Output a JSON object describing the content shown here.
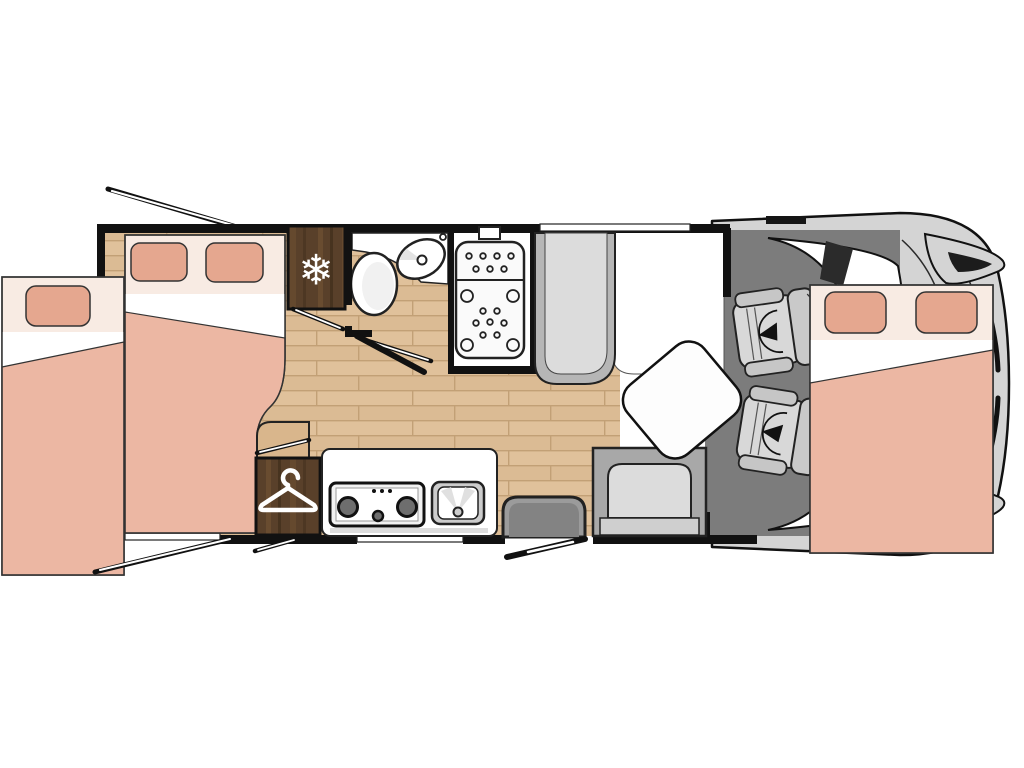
{
  "title": "Motorhome floor plan (top view)",
  "icons": {
    "snowflake": "❄"
  },
  "colors": {
    "white": "#ffffff",
    "wall": "#111111",
    "outline": "#222222",
    "wood_base": "#e0c19b",
    "wood_alt": "#d6b58d",
    "wood_line": "#c2a076",
    "cabinet_wood": "#59402a",
    "cabinet_wood_light": "#735434",
    "cabinet_wood_dark": "#47331f",
    "step_wood": "#d9b68c",
    "bed_header": "#f8ebe3",
    "bed_pillow": "#e5a78f",
    "bed_blanket": "#ecb7a3",
    "cab_floor": "#7c7c7c",
    "vehicle_body": "#d4d4d4",
    "glass": "#ffffff",
    "pillar": "#2b2b2b",
    "unit_outer": "#b6b6b6",
    "unit_inner": "#dcdcdc",
    "bench_outer": "#a8a8a8",
    "bench_cushion": "#dcdcdc",
    "bench_band": "#cfcfcf",
    "step_outer": "#9b9b9b",
    "step_inner": "#838383",
    "seat_base": "#d8d8d8",
    "seat_armrest": "#c6c6c6",
    "seat_back": "#c9c9c9",
    "table": "#fdfdfd",
    "fixture": "#ffffff",
    "hob_plate": "#f2f2f2",
    "burner": "#6e6e6e",
    "sink_frame": "#cccccc",
    "shower_tray": "#fafafa"
  }
}
